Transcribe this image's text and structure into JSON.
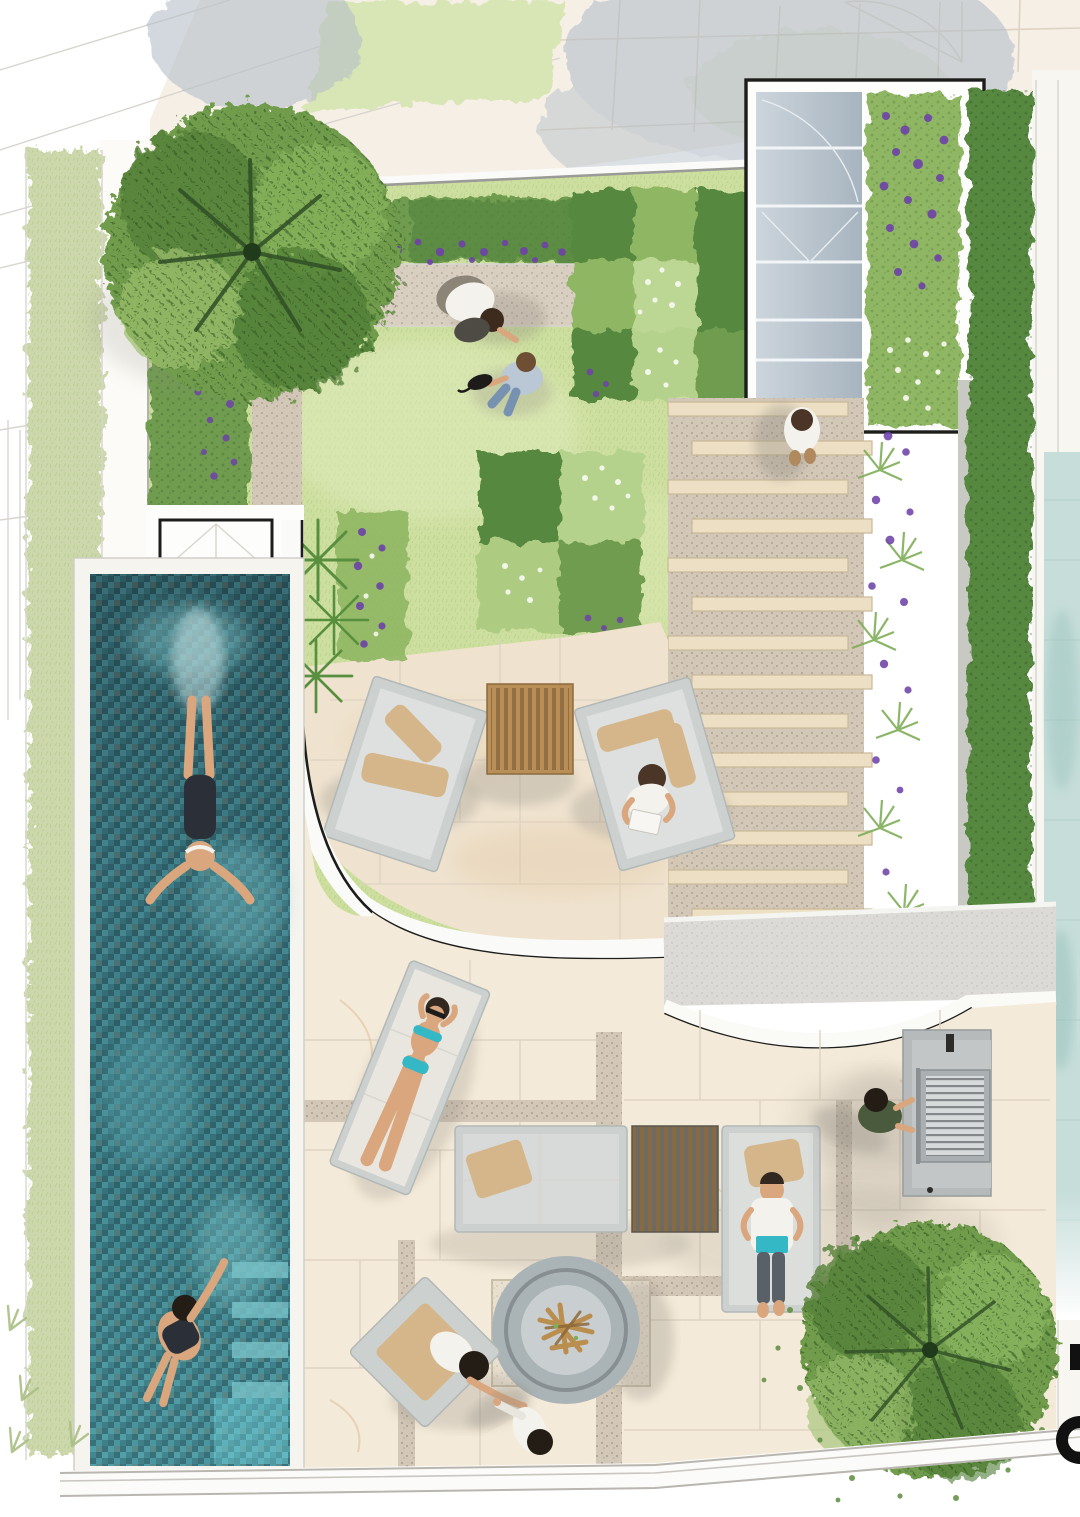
{
  "document": {
    "kind": "landscape-architecture-site-plan",
    "view": "top-down watercolor render",
    "title_text_visible": "",
    "clipped_marks_right_edge": [
      "black-square-fragment",
      "black-ring-fragment"
    ]
  },
  "palette": {
    "paper": "#ffffff",
    "paving_out": "#f6efe6",
    "paving_line": "#ddd2c2",
    "lawn": "#cddf9f",
    "lawn_light": "#e0eabd",
    "verge": "#d8e5b4",
    "sage": "#ccd8ab",
    "hedge_dark": "#57883f",
    "hedge_mid": "#6f9c4f",
    "hedge_light": "#8fb763",
    "ghost": "#b6c1c9",
    "purple": "#6e42a8",
    "daisy": "#f6f9ee",
    "path_gravel": "#d9cfc0",
    "terrace": "#efe3cf",
    "marble": "#f4ead9",
    "vein": "#d9b98e",
    "gravelstrip": "#d3c7b7",
    "plank": "#ecdfc4",
    "plank_edge": "#c9b896",
    "glass_top": "#ccd5dc",
    "glass_bot": "#a7b4bf",
    "mullion": "#f2f5f7",
    "pool_deep": "#2c565e",
    "pool_mid": "#3a7680",
    "pool_light": "#5fb0ba",
    "pool_pale": "#8ed2d6",
    "coping": "#f6f4ee",
    "wall_white": "#fafaf8",
    "outline": "#1d1d1b",
    "concrete": "#dbdad6",
    "gray_f": "#ccd0cf",
    "gray_f2": "#b2b8b7",
    "cushion": "#d5b68a",
    "wood": "#b98f57",
    "wood_dark": "#85613a",
    "fire_ring": "#aab3b6",
    "fire_plate": "#c9ced0",
    "log": "#b98e4e",
    "bbq": "#b6babb",
    "grate": "#d6dadb",
    "grate_line": "#75797b",
    "skin": "#d9a67e",
    "hair_dark": "#33281f",
    "white_cloth": "#f3f2ed",
    "denim": "#7792b0",
    "teal_item": "#35b8c6",
    "olive": "#4a5a3c",
    "neighbor_pool": "#c6ddd9",
    "shadow": "#8e897f"
  },
  "scene": {
    "areas": [
      {
        "name": "street-paving-top",
        "material": "stone-tiles"
      },
      {
        "name": "upper-lawn",
        "material": "grass"
      },
      {
        "name": "gravel-path",
        "material": "gravel"
      },
      {
        "name": "checkerboard-planting-beds",
        "count": 2
      },
      {
        "name": "glass-skylight-corridor",
        "material": "glass"
      },
      {
        "name": "roof-planter-purple",
        "flowers": "purple"
      },
      {
        "name": "timber-sleeper-steps",
        "plank_count": 14
      },
      {
        "name": "upper-terrace-paving",
        "material": "sandstone"
      },
      {
        "name": "curved-retaining-wall",
        "outline": "black"
      },
      {
        "name": "lower-terrace-paving",
        "material": "marble"
      },
      {
        "name": "lap-pool",
        "material": "teal-mosaic"
      },
      {
        "name": "pool-shallow-steps",
        "position": "bottom"
      },
      {
        "name": "bbq-island",
        "appliance": "grill"
      },
      {
        "name": "fire-pit",
        "shape": "round-bowl"
      },
      {
        "name": "boundary-hedges",
        "sides": [
          "left",
          "top",
          "right"
        ]
      },
      {
        "name": "neighbor-water-feature",
        "side": "right"
      }
    ],
    "trees": [
      {
        "name": "large-tree-top-left"
      },
      {
        "name": "large-tree-bottom-right"
      },
      {
        "name": "ghost-street-trees",
        "count": 2
      }
    ],
    "furniture": [
      {
        "name": "lounge-chair-left"
      },
      {
        "name": "slatted-coffee-table"
      },
      {
        "name": "lounge-chair-right"
      },
      {
        "name": "sun-lounger"
      },
      {
        "name": "outdoor-sofa"
      },
      {
        "name": "slatted-low-table"
      },
      {
        "name": "daybed"
      },
      {
        "name": "fire-pit-armchair"
      }
    ],
    "people": [
      {
        "name": "gardener-kneeling-on-path"
      },
      {
        "name": "person-sitting-on-lawn-with-pet"
      },
      {
        "name": "person-walking-down-steps"
      },
      {
        "name": "person-reading-in-chair"
      },
      {
        "name": "sunbather-on-lounger",
        "swimwear_color": "turquoise"
      },
      {
        "name": "person-lying-on-daybed-reading"
      },
      {
        "name": "person-at-bbq"
      },
      {
        "name": "person-seated-by-fire-pit"
      },
      {
        "name": "person-standing-by-fire-pit"
      },
      {
        "name": "swimmer-mid-pool"
      },
      {
        "name": "swimmer-bottom-pool"
      }
    ]
  }
}
